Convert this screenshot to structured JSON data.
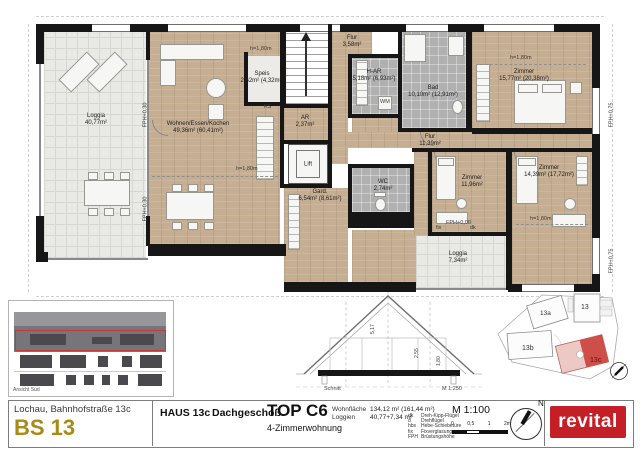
{
  "plan": {
    "rooms": [
      {
        "name": "Loggia",
        "area": "40,77m²"
      },
      {
        "name": "Wohnen/Essen/Kochen",
        "area": "49,36m² (60,41m²)"
      },
      {
        "name": "Speis",
        "area": "2,62m² (4,32m²)"
      },
      {
        "name": "Flur",
        "area": "3,58m²"
      },
      {
        "name": "H-AR",
        "area": "5,18m² (6,93m²)"
      },
      {
        "name": "Bad",
        "area": "10,10m² (12,91m²)"
      },
      {
        "name": "Zimmer",
        "area": "15,77m² (20,38m²)"
      },
      {
        "name": "AR",
        "area": "2,37m²"
      },
      {
        "name": "Flur",
        "area": "11,39m²"
      },
      {
        "name": "Gard.",
        "area": "6,54m² (8,61m²)"
      },
      {
        "name": "WC",
        "area": "2,74m²"
      },
      {
        "name": "Zimmer",
        "area": "11,96m²"
      },
      {
        "name": "Zimmer",
        "area": "14,39m² (17,72m²)"
      },
      {
        "name": "Loggia",
        "area": "7,34m²"
      }
    ],
    "annotations": {
      "h180": "h=1,80m",
      "fph030": "FPH+0,30",
      "fph075": "FPH+0,75",
      "fph000": "FPH+0,00",
      "fix": "fix",
      "dk": "dk",
      "wm": "WM",
      "ks": "KS",
      "lift": "Lift"
    }
  },
  "elevation": {
    "label": "Ansicht Süd"
  },
  "section": {
    "label": "Schnitt",
    "scale": "M 1:250",
    "dims": [
      "5,17",
      "2,55",
      "1,80"
    ]
  },
  "site": {
    "buildings": [
      "13a",
      "13",
      "13b",
      "13c"
    ]
  },
  "title_block": {
    "address": "Lochau, Bahnhofstraße 13c",
    "code": "BS 13",
    "house": "HAUS 13c",
    "floor": "Dachgeschoß",
    "unit": "TOP C6",
    "unit_type": "4-Zimmerwohnung",
    "areas": [
      {
        "label": "Wohnfläche",
        "value": "134,12 m² (161,44 m²)"
      },
      {
        "label": "Loggien",
        "value": "40,77+7,34 m²"
      }
    ],
    "legend": [
      {
        "abbr": "dk",
        "label": "Dreh-Kipp-Flügel"
      },
      {
        "abbr": "d",
        "label": "Drehflügel"
      },
      {
        "abbr": "hbs",
        "label": "Hebe-Schiebetüre"
      },
      {
        "abbr": "fix",
        "label": "Fixverglasung"
      },
      {
        "abbr": "FPH",
        "label": "Brüstungshöhe"
      }
    ],
    "scale": "M 1:100",
    "scale_ticks": [
      "0",
      "0,5",
      "1",
      "2m"
    ],
    "north": "N",
    "logo": "revital"
  }
}
